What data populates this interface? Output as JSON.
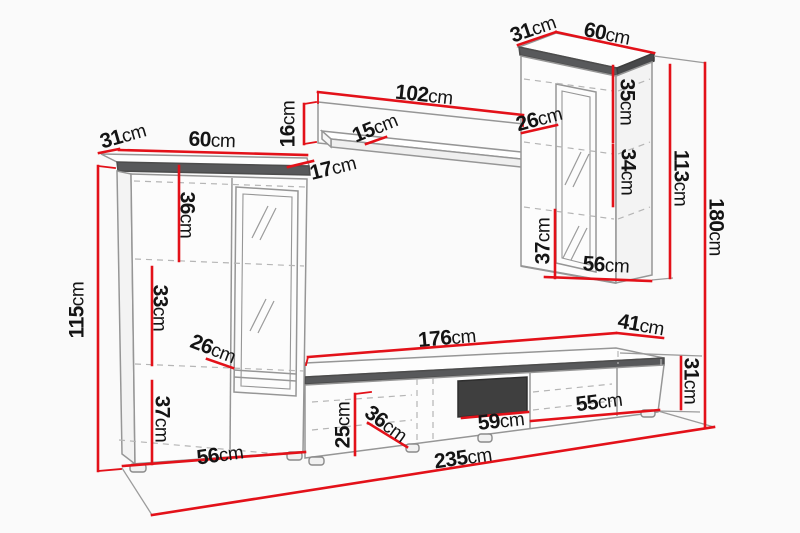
{
  "unit": "cm",
  "colors": {
    "dimension_red": "#e31119",
    "outline_gray": "#969696",
    "cornice_dark": "#58595b",
    "niche_dark": "#3f3f3f",
    "dashed_gray": "#b5b5b5",
    "text": "#141414",
    "background": "#fafafa"
  },
  "dimensions": {
    "tall_cabinet": {
      "depth": "31",
      "width": "60",
      "height": "115",
      "top_section": "36",
      "middle_section": "33",
      "interior_depth": "26",
      "bottom_section": "37",
      "base_width": "56"
    },
    "wall_shelf": {
      "width": "102",
      "height": "16",
      "bottom_depth": "17",
      "top_depth": "15"
    },
    "hanging_cabinet": {
      "depth": "31",
      "width": "60",
      "top_section": "35",
      "shelf_depth": "26",
      "middle_section": "34",
      "height": "113",
      "bottom_section": "37",
      "base_width": "56"
    },
    "tv_stand": {
      "top_length": "176",
      "right_depth": "41",
      "right_height": "31",
      "front_height": "25",
      "interior_depth": "36",
      "niche_width": "59",
      "right_door_width": "55"
    },
    "overall": {
      "height": "180",
      "length": "235"
    }
  }
}
